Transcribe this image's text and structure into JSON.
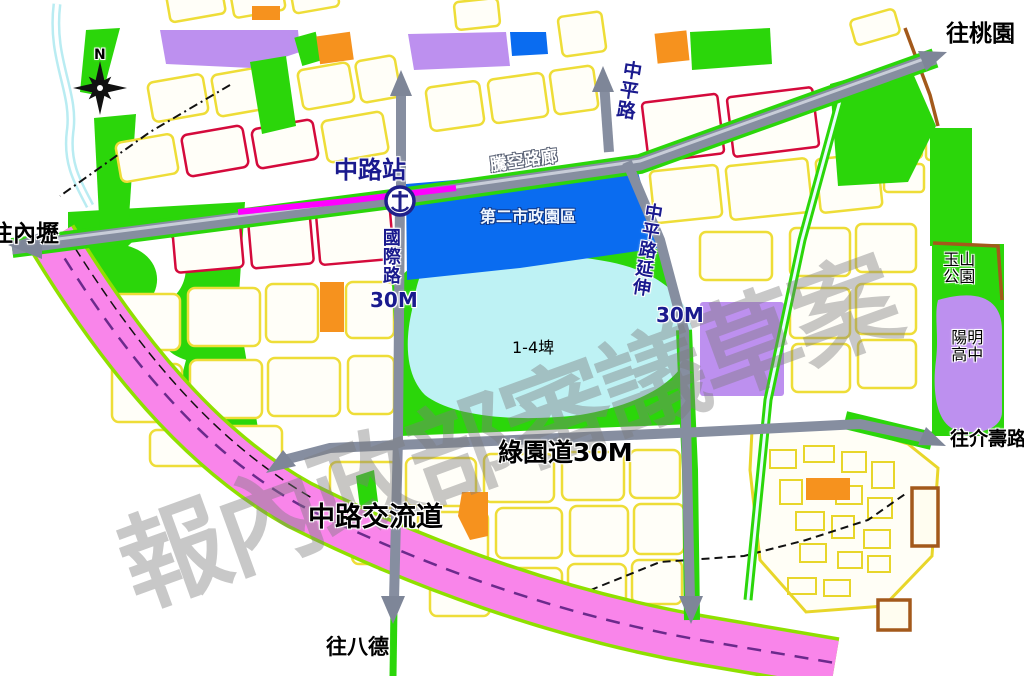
{
  "map": {
    "watermark": "報內政部審議草案",
    "compass": {
      "north_label": "N"
    },
    "station": {
      "label": "中路站"
    },
    "zones": {
      "civic_district": "第二市政園區",
      "pond": "1-4埤",
      "yushan_park": "玉山公園",
      "yangming_high_school": "陽明高中"
    },
    "roads": {
      "zhongping_road": "中平路",
      "elevated_corridor": "騰空路廊",
      "guoji_road": "國際路",
      "guoji_road_width": "30M",
      "zhongping_extension": "中平路延伸",
      "zhongping_extension_width": "30M",
      "green_parkway": "綠園道30M",
      "interchange": "中路交流道"
    },
    "directions": {
      "to_taoyuan": "往桃園",
      "to_neili": "往內壢",
      "to_jieshou_road": "往介壽路",
      "to_bade": "往八德"
    },
    "colors": {
      "road_gray": "#868EA0",
      "park_green": "#2BD60A",
      "civic_blue": "#0A6CF0",
      "pond_cyan": "#BEF2F4",
      "school_purple": "#BD90EF",
      "market_orange": "#F6921E",
      "expressway_pink": "#F985EA",
      "station_magenta": "#FF00FF",
      "street_yellow": "#EEDD38",
      "commercial_red": "#D40A3C",
      "boundary_brown": "#A3591B"
    }
  }
}
